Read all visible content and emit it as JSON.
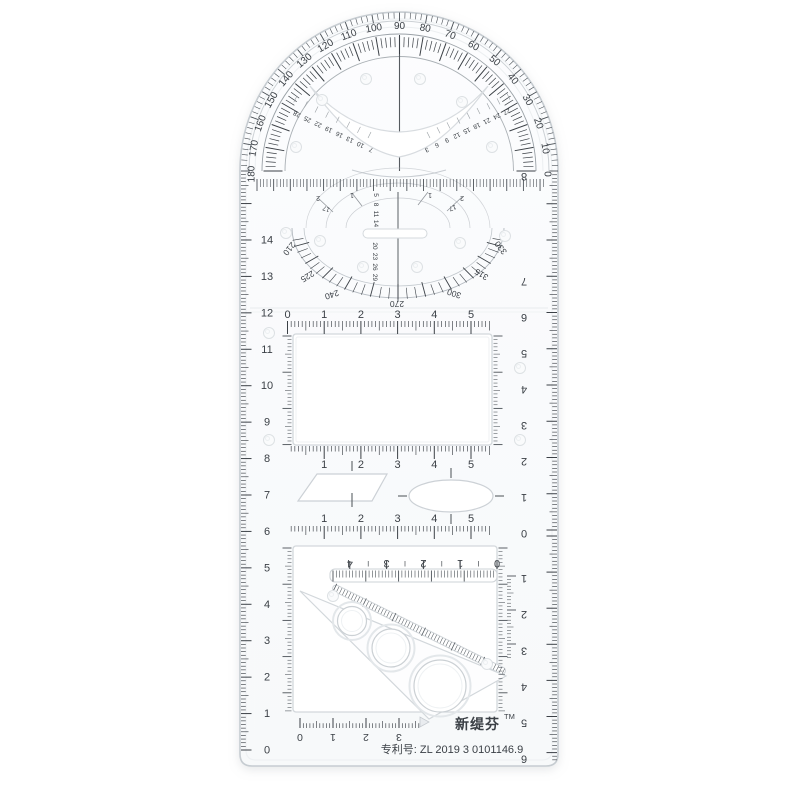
{
  "branding": {
    "name": "新缇芬",
    "trademark": "TM",
    "patent": "专利号: ZL 2019 3 0101146.9"
  },
  "protractor": {
    "degree_labels": [
      0,
      10,
      20,
      30,
      40,
      50,
      60,
      70,
      80,
      90,
      100,
      110,
      120,
      130,
      140,
      150,
      160,
      170,
      180
    ]
  },
  "dial": {
    "degree_labels": [
      210,
      225,
      240,
      270,
      300,
      315,
      330
    ],
    "center_column_top": [
      5,
      8,
      11,
      14
    ],
    "center_column_bottom": [
      20,
      23,
      26,
      29
    ],
    "upper_arc_labels": [
      "2",
      "1",
      "1",
      "2"
    ],
    "side_labels": [
      "17",
      "17"
    ]
  },
  "notch_guides": {
    "left": [
      7,
      10,
      13,
      16,
      19,
      22,
      25,
      28
    ],
    "right": [
      3,
      6,
      9,
      12,
      15,
      18,
      21,
      24,
      27
    ]
  },
  "horizontal_scales": {
    "top": [
      0,
      1,
      2,
      3,
      4,
      5
    ],
    "middle_upper": [
      1,
      2,
      3,
      4,
      5
    ],
    "middle_lower": [
      1,
      2,
      3,
      4,
      5
    ],
    "inverted": [
      4,
      3,
      2,
      1,
      0
    ],
    "bottom": [
      0,
      1,
      2,
      3
    ]
  },
  "vertical_scales": {
    "left": [
      0,
      1,
      2,
      3,
      4,
      5,
      6,
      7,
      8,
      9,
      10,
      11,
      12,
      13,
      14
    ],
    "right_upper": [
      8,
      7,
      6,
      5,
      4,
      3,
      2,
      1,
      0
    ],
    "right_lower": [
      1,
      2,
      3,
      4,
      5,
      6
    ]
  },
  "colors": {
    "ink": "#3b4046",
    "edge": "#c9ced3",
    "edge_soft": "#e6e9ec",
    "body": "#fbfcfd",
    "cutout": "#ffffff"
  }
}
